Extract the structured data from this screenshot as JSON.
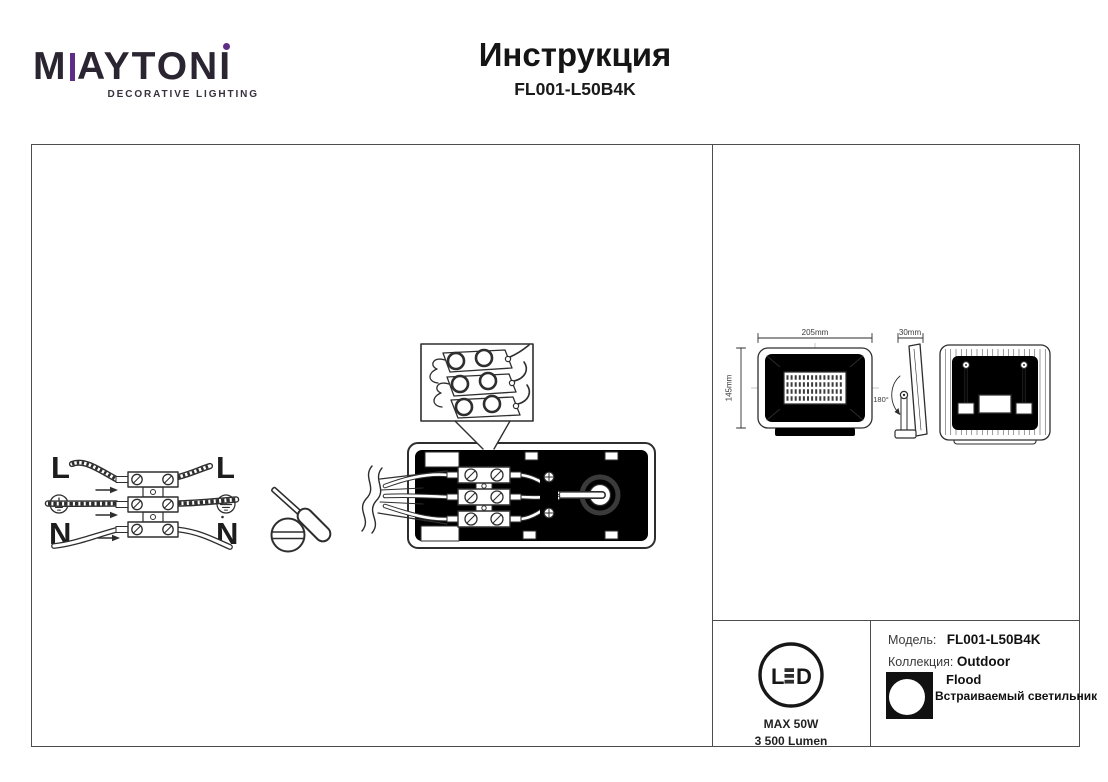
{
  "header": {
    "brand_m": "M",
    "brand_rest": "AYTONI",
    "tagline": "DECORATIVE LIGHTING",
    "title": "Инструкция",
    "model": "FL001-L50B4K"
  },
  "wiring": {
    "left_line": "L",
    "left_neutral": "N",
    "right_line": "L",
    "right_neutral": "N"
  },
  "dimensions": {
    "width": "205mm",
    "height": "145mm",
    "depth": "30mm",
    "tilt": "180°"
  },
  "badge": {
    "led_l": "L",
    "led_d": "D",
    "max_power": "MAX 50W",
    "luminous_flux": "3 500 Lumen"
  },
  "product": {
    "model_label": "Модель:",
    "model_value": "FL001-L50B4K",
    "collection_label": "Коллекция:",
    "collection_value": "Outdoor",
    "type_line1": "Flood",
    "type_line2": "Встраиваемый светильник"
  },
  "icons": {
    "earth": "protective-earth-icon",
    "screwdriver": "screwdriver-icon",
    "led_badge": "led-circle-icon",
    "flood": "floodlight-icon"
  },
  "colors": {
    "accent_purple": "#5E2D85",
    "ink": "#2e2e2e"
  }
}
